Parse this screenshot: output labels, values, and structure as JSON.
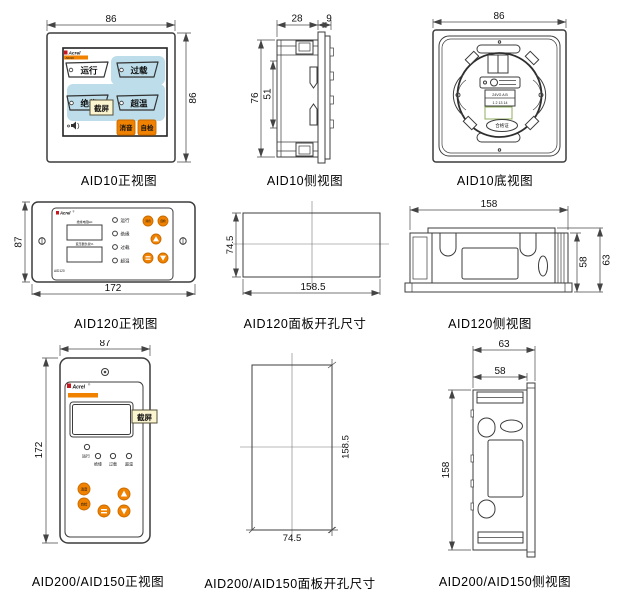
{
  "colors": {
    "accent_orange": "#F08200",
    "indicator_blue": "#BCDDE9",
    "brand_red": "#C8171E",
    "tag_yellow": "#FBF5D0",
    "line_dark": "#3C3C3C"
  },
  "icons": {
    "speaker": "speaker-icon",
    "screw_slot": "screw-slot-icon",
    "up_arrow": "up-triangle-icon",
    "down_arrow": "down-triangle-icon",
    "menu": "menu-bars-icon"
  },
  "figures": {
    "aid10_front": {
      "caption": "AID10正视图",
      "dims": {
        "width": "86",
        "height": "86"
      },
      "brand": {
        "name": "Acrel",
        "model": "AID10"
      },
      "indicators": {
        "run": "运行",
        "overload": "过载",
        "insulation": "绝缘",
        "overtemp": "超温"
      },
      "buttons": {
        "mute": "消音",
        "selftest": "自检"
      },
      "tag": "截屏"
    },
    "aid10_side": {
      "caption": "AID10侧视图",
      "dims": {
        "body_depth": "28",
        "flange_depth": "9",
        "height": "76",
        "clip_span": "51"
      }
    },
    "aid10_bottom": {
      "caption": "AID10底视图",
      "dims": {
        "width": "86"
      },
      "terminal": {
        "row1": "24VG A B",
        "row2": "1 2 13 14"
      },
      "cert_label": "合格证"
    },
    "aid120_front": {
      "caption": "AID120正视图",
      "dims": {
        "height": "87",
        "width": "172"
      },
      "brand": {
        "name": "Acrel",
        "mark": "®",
        "model": "AID120"
      },
      "displays": {
        "label1": "绝缘电阻kΩ",
        "label2": "变压器负载%"
      },
      "indicators": {
        "run": "运行",
        "insulation": "绝缘",
        "overload": "过载",
        "overtemp": "超温"
      },
      "buttons": {
        "mute": "消音",
        "selftest": "自检"
      }
    },
    "aid120_cutout": {
      "caption": "AID120面板开孔尺寸",
      "dims": {
        "height": "74.5",
        "width": "158.5"
      }
    },
    "aid120_side": {
      "caption": "AID120侧视图",
      "dims": {
        "width": "158",
        "body_height": "58",
        "total_height": "63"
      }
    },
    "aid200_front": {
      "caption": "AID200/AID150正视图",
      "dims": {
        "width": "87",
        "height": "172"
      },
      "brand": {
        "name": "Acrel",
        "mark": "®"
      },
      "indicators": {
        "run": "运行",
        "insulation": "绝缘",
        "overload": "过载",
        "overtemp": "超温"
      },
      "buttons": {
        "mute": "消音",
        "selftest": "自检"
      },
      "tag": "截屏"
    },
    "aid200_cutout": {
      "caption": "AID200/AID150面板开孔尺寸",
      "dims": {
        "height": "158.5",
        "width": "74.5"
      }
    },
    "aid200_side": {
      "caption": "AID200/AID150侧视图",
      "dims": {
        "total_depth": "63",
        "body_depth": "58",
        "height": "158"
      }
    }
  }
}
